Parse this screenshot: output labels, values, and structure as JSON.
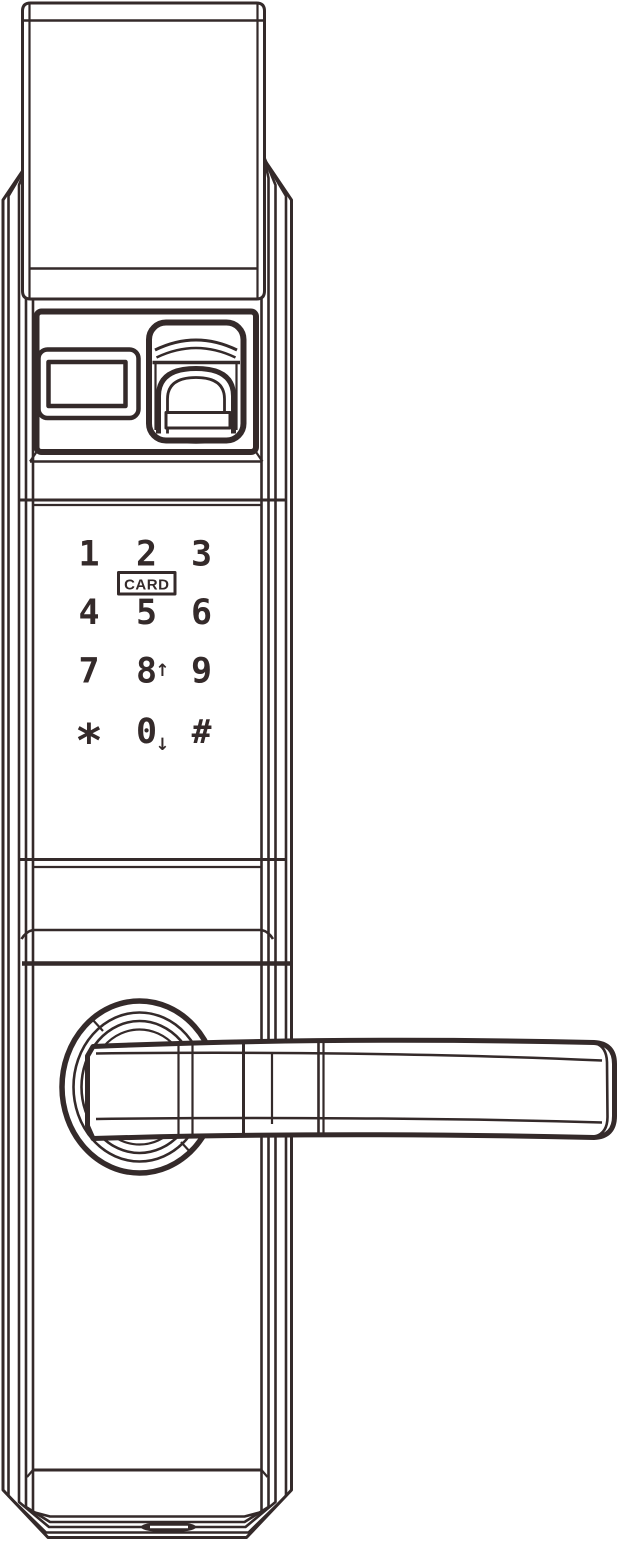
{
  "colors": {
    "line": "#342a2a",
    "bg": "#ffffff"
  },
  "keypad": {
    "card_label": "CARD",
    "rows": [
      [
        {
          "label": "1"
        },
        {
          "label": "2"
        },
        {
          "label": "3"
        }
      ],
      [
        {
          "label": "4"
        },
        {
          "label": "5"
        },
        {
          "label": "6"
        }
      ],
      [
        {
          "label": "7"
        },
        {
          "label": "8",
          "suffix": "↑"
        },
        {
          "label": "9"
        }
      ],
      [
        {
          "label": "*"
        },
        {
          "label": "0",
          "suffix": "↓"
        },
        {
          "label": "#"
        }
      ]
    ]
  }
}
